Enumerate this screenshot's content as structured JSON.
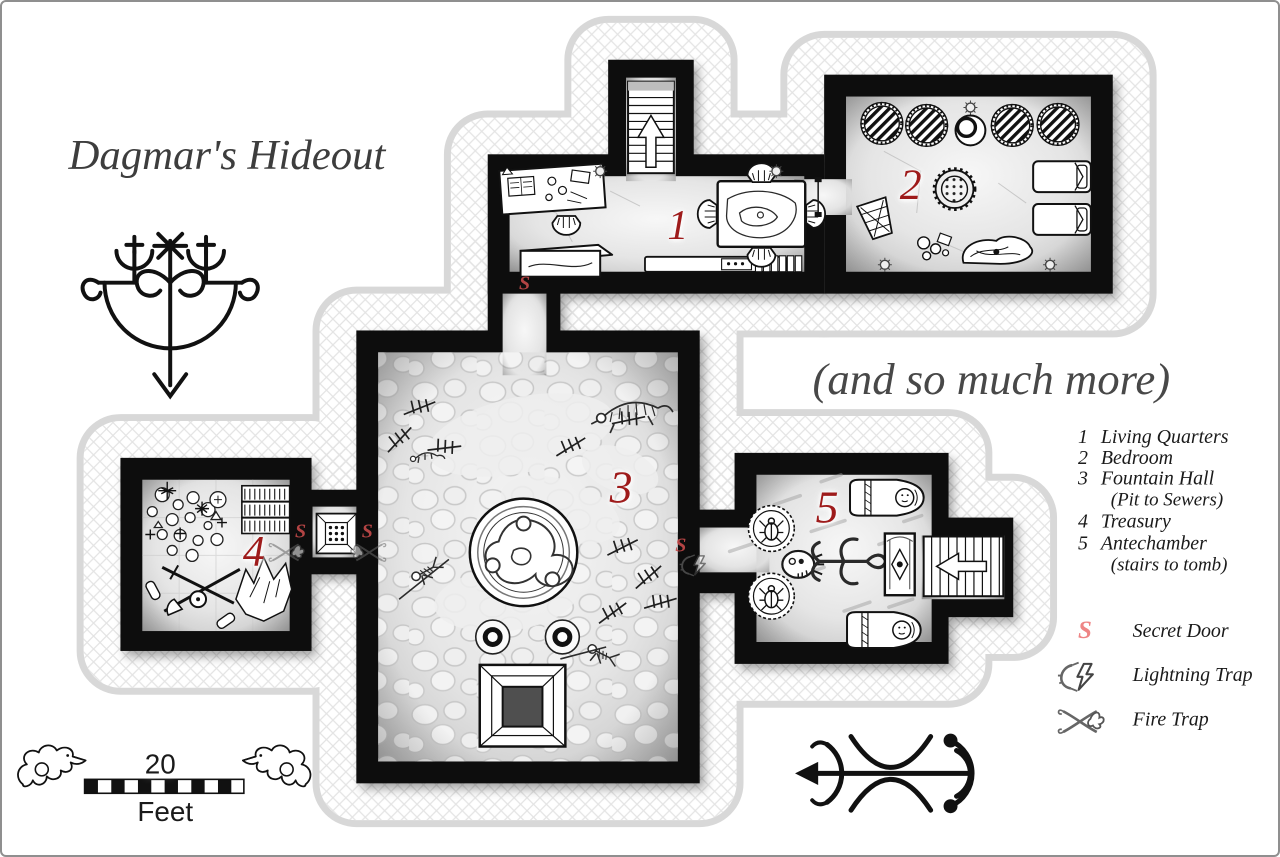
{
  "title": "Dagmar's Hideout",
  "subtitle": "(and so much more)",
  "rooms": [
    {
      "number": "1",
      "name": "Living Quarters"
    },
    {
      "number": "2",
      "name": "Bedroom"
    },
    {
      "number": "3",
      "name": "Fountain Hall",
      "note": "(Pit to Sewers)"
    },
    {
      "number": "4",
      "name": "Treasury"
    },
    {
      "number": "5",
      "name": "Antechamber",
      "note": "(stairs to tomb)"
    }
  ],
  "legend": {
    "secret_door": {
      "symbol": "S",
      "label": "Secret Door"
    },
    "lightning_trap": {
      "label": "Lightning Trap"
    },
    "fire_trap": {
      "label": "Fire Trap"
    }
  },
  "scale_bar": {
    "value": "20",
    "unit": "Feet"
  },
  "colors": {
    "room_number": "#9E1B1B",
    "secret_marker_map": "#C64A4A",
    "secret_marker_legend": "#EE8585",
    "wall": "#111111",
    "buffer_outline": "#D8D8D8"
  },
  "icons": {
    "secret-door-marker": "letter S",
    "lightning-trap-icon": "lightning bolt in clamp",
    "fire-trap-icon": "crossed rods with flame",
    "stairs-up-icon": "arrow up staircase",
    "stairs-to-tomb-icon": "arrow left staircase",
    "torch-sconce-icon": "round wall torch",
    "veve-sigil": "arrowed voodoo sigil",
    "compass-sigil": "arrow with crescents",
    "dragon-ornament": "winged dragon scale ends"
  }
}
